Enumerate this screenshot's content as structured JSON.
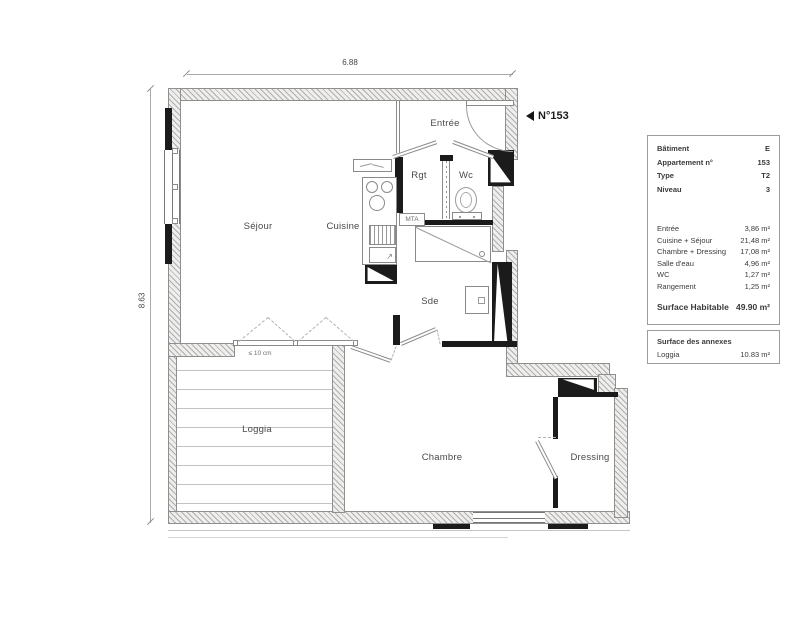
{
  "plan": {
    "unit_number": "N°153",
    "dim_width": "6.88",
    "dim_height": "8.63",
    "rooms": {
      "sejour": "Séjour",
      "cuisine": "Cuisine",
      "rgt": "Rgt",
      "entree": "Entrée",
      "wc": "Wc",
      "sde": "Sde",
      "loggia": "Loggia",
      "chambre": "Chambre",
      "dressing": "Dressing"
    },
    "labels": {
      "mta": "MTA",
      "window_clearance": "≤ 10 cm"
    }
  },
  "info_panel": {
    "details": [
      {
        "label": "Bâtiment",
        "value": "E"
      },
      {
        "label": "Appartement n°",
        "value": "153"
      },
      {
        "label": "Type",
        "value": "T2"
      },
      {
        "label": "Niveau",
        "value": "3"
      }
    ],
    "areas": [
      {
        "label": "Entrée",
        "value": "3,86 m²"
      },
      {
        "label": "Cuisine + Séjour",
        "value": "21,48 m²"
      },
      {
        "label": "Chambre + Dressing",
        "value": "17,08 m²"
      },
      {
        "label": "Salle d'eau",
        "value": "4,96 m²"
      },
      {
        "label": "WC",
        "value": "1,27 m²"
      },
      {
        "label": "Rangement",
        "value": "1,25 m²"
      }
    ],
    "total": {
      "label": "Surface Habitable",
      "value": "49.90 m²"
    }
  },
  "annex_panel": {
    "title": "Surface des annexes",
    "rows": [
      {
        "label": "Loggia",
        "value": "10.83 m²"
      }
    ]
  }
}
